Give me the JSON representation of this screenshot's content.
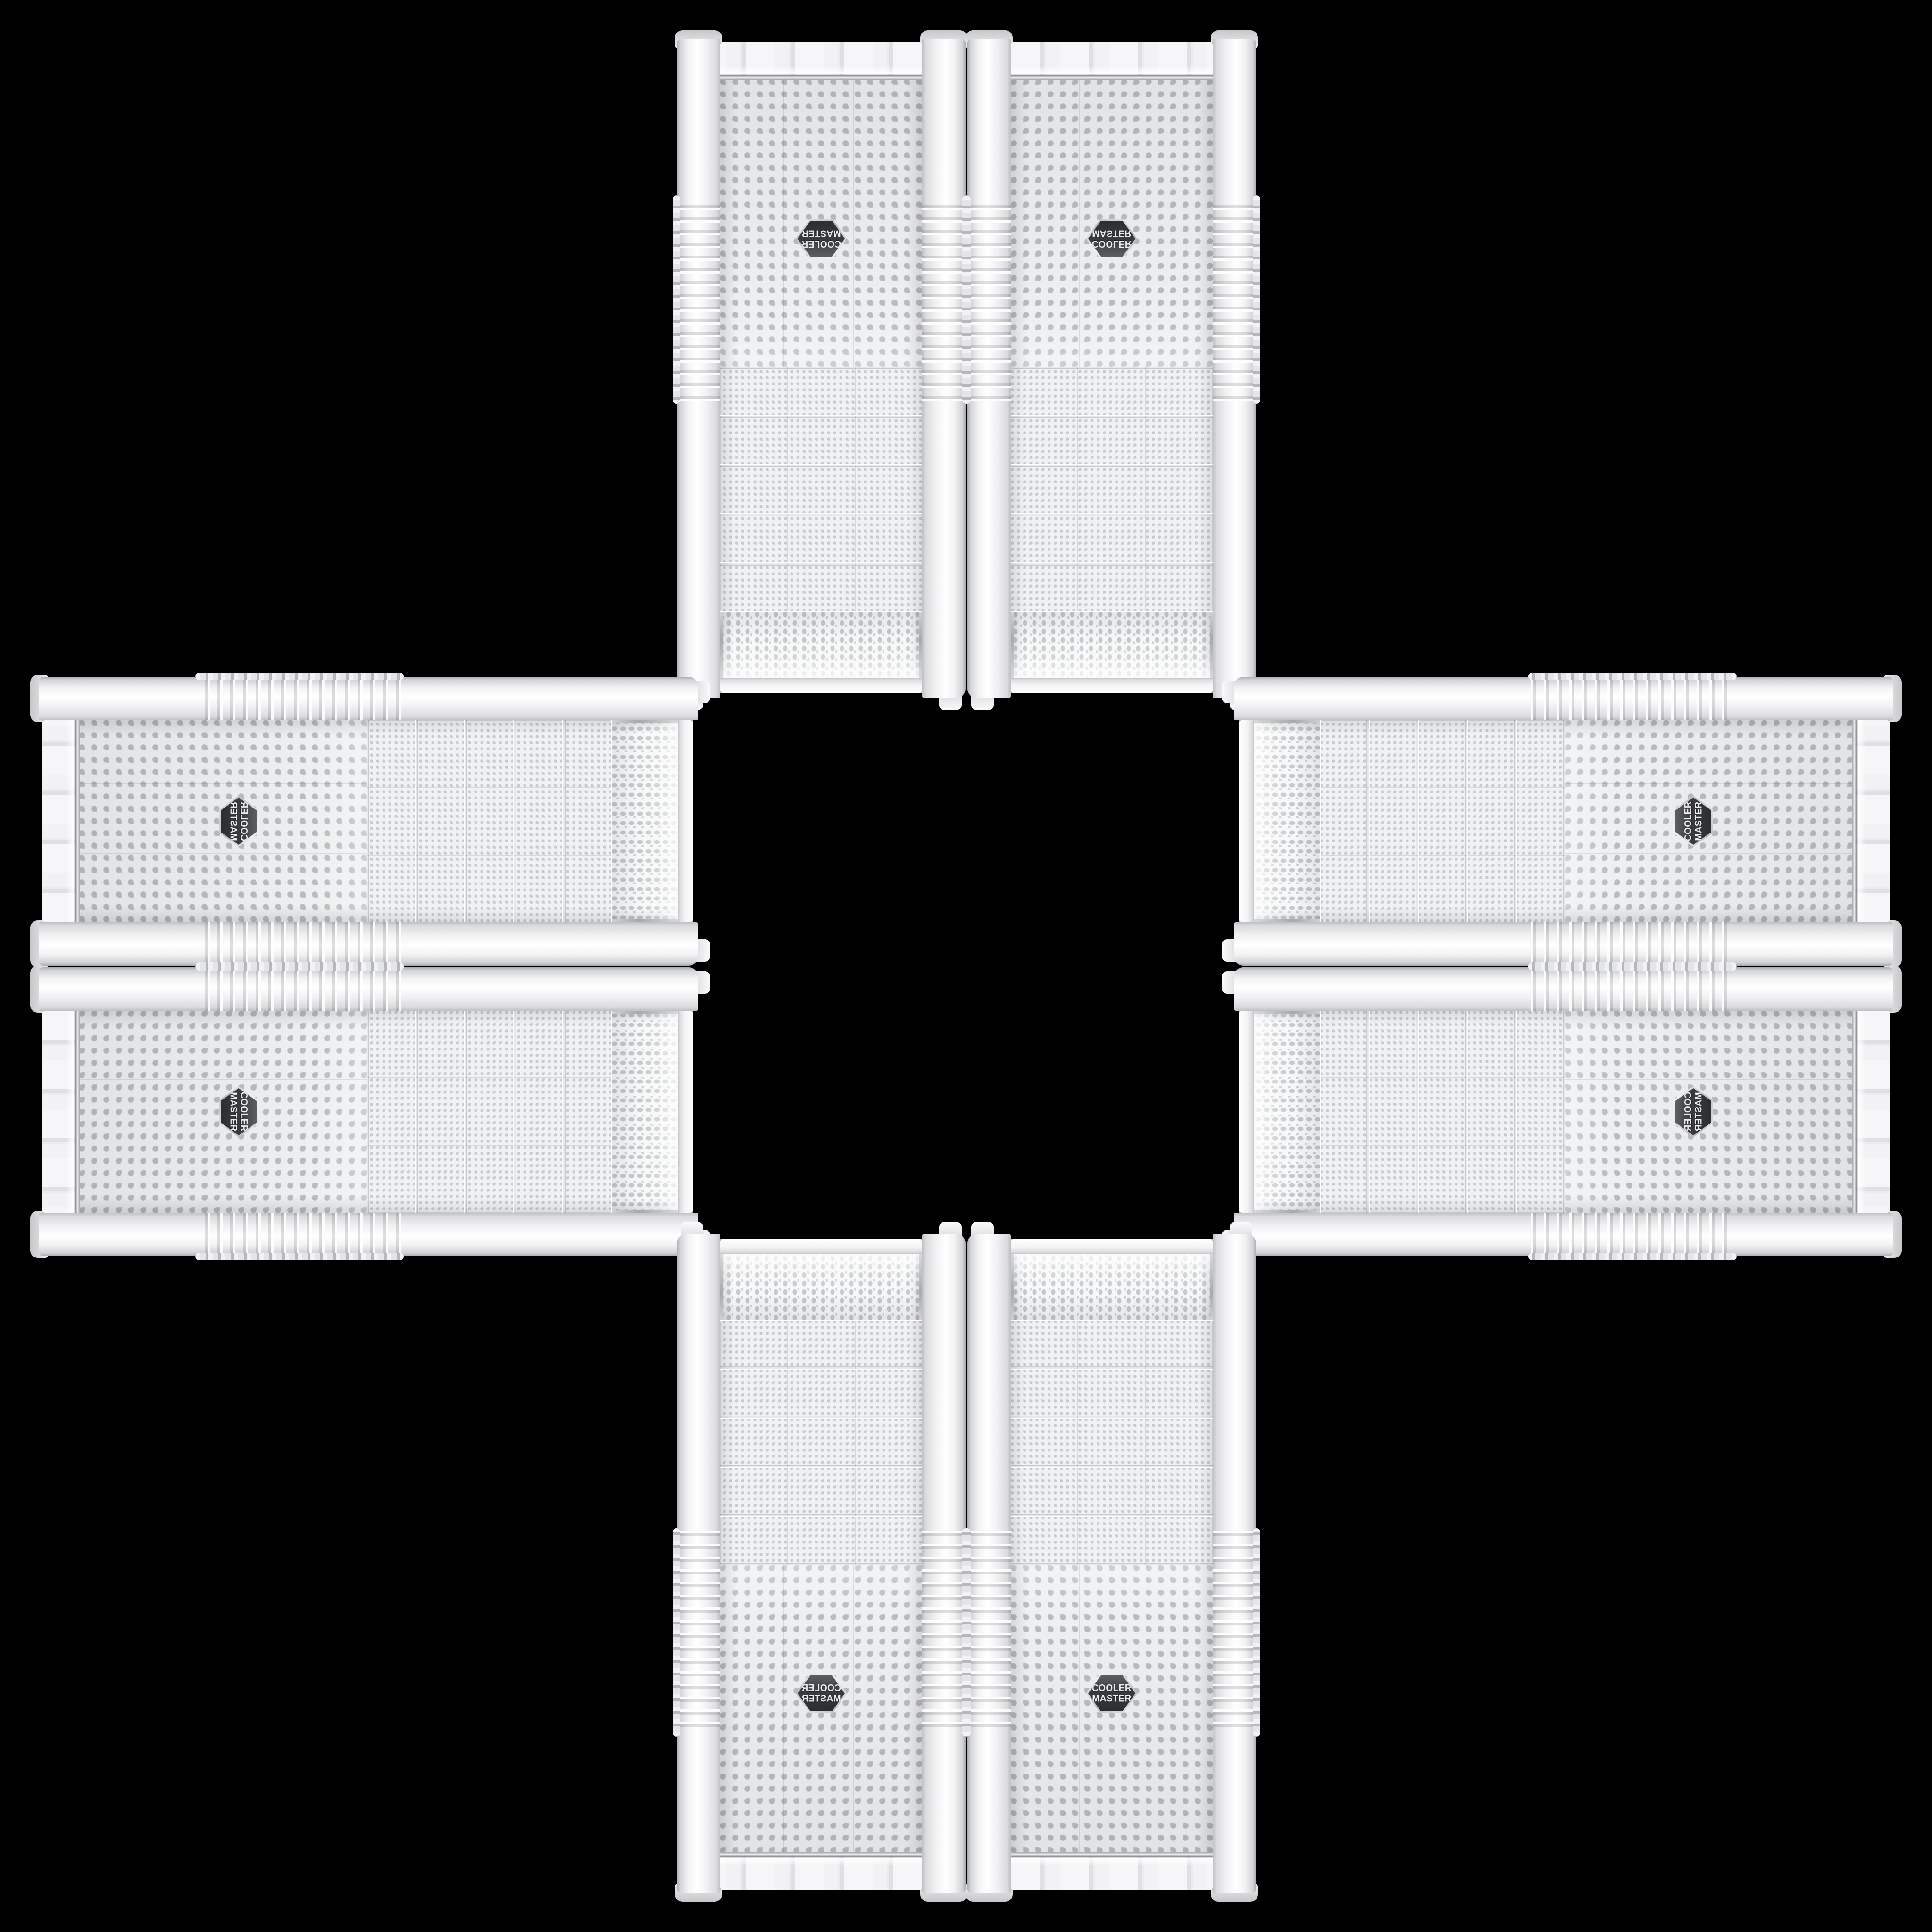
{
  "scene": {
    "background_color": "#000000",
    "subject": "Eight white Cooler Master mesh-front PC tower cases arranged in a cross on a black background",
    "arrangement": "plus-cross, mirror/rotation orbit of one product photo, case tops facing center"
  },
  "brand": {
    "line1": "COOLER",
    "line2": "MASTER",
    "logo_shape": "hexagon-badge"
  },
  "colors": {
    "background": "#000000",
    "case_shell": "#f4f4f6",
    "mesh_base": "#eef0f1",
    "mesh_dot": "#bfc1c3",
    "chrome_trim": "#c7c9cc",
    "badge_background": "#3a3c3f",
    "badge_text": "#ededee"
  },
  "cases": [
    {
      "id": "top-left",
      "placement": "top-left",
      "orientation": "rotated-180"
    },
    {
      "id": "top-right",
      "placement": "top-right",
      "orientation": "flipped-vertical"
    },
    {
      "id": "left-top",
      "placement": "left-top",
      "orientation": "rotated-90ccw-mirrored"
    },
    {
      "id": "left-bottom",
      "placement": "left-bottom",
      "orientation": "rotated-90cw"
    },
    {
      "id": "right-top",
      "placement": "right-top",
      "orientation": "rotated-90ccw"
    },
    {
      "id": "right-bottom",
      "placement": "right-bottom",
      "orientation": "rotated-90ccw-flipped"
    },
    {
      "id": "bottom-left",
      "placement": "bottom-left",
      "orientation": "mirrored-horizontal"
    },
    {
      "id": "bottom-right",
      "placement": "bottom-right",
      "orientation": "upright"
    }
  ]
}
